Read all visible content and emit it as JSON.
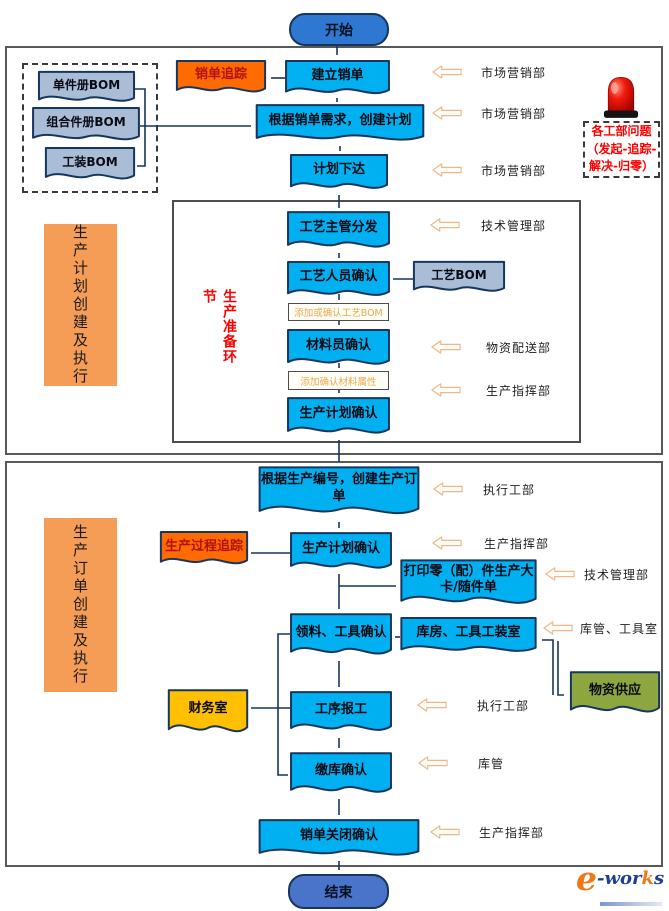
{
  "colors": {
    "process_fill": "#00b0f0",
    "doc_border": "#17365d",
    "bom_fill": "#a9bdd7",
    "tracking_fill": "#ff6b00",
    "tracking_text": "#b01210",
    "finance_fill": "#ffc000",
    "supply_fill": "#8ea640",
    "band_fill": "#f59d56",
    "start_fill": "#2e78d2",
    "end_fill": "#4a74c9",
    "line": "#17365d",
    "block_arrow_stroke": "#efb789",
    "block_arrow_fill": "#fffdf8",
    "red_text": "#ff0000",
    "note_text": "#e8a84f",
    "logo_orange": "#f07818",
    "logo_blue": "#1c3f94"
  },
  "nodes": {
    "start": "开始",
    "end": "结束",
    "create_sales_order": "建立销单",
    "sales_order_tracking": "销单追踪",
    "create_plan": "根据销单需求，创建计划",
    "plan_release": "计划下达",
    "bom_single": "单件册BOM",
    "bom_combo": "组合件册BOM",
    "bom_tooling": "工装BOM",
    "craft_dispatch": "工艺主管分发",
    "craft_confirm": "工艺人员确认",
    "craft_bom": "工艺BOM",
    "material_confirm": "材料员确认",
    "plan_confirm": "生产计划确认",
    "create_prod_order": "根据生产编号，创建生产订单",
    "prod_plan_confirm": "生产计划确认",
    "process_tracking": "生产过程追踪",
    "print_card": "打印零（配）件生产大卡/随件单",
    "pick_confirm": "领料、工具确认",
    "warehouse_room": "库房、工具工装室",
    "supply": "物资供应",
    "process_report": "工序报工",
    "finance": "财务室",
    "stockin_confirm": "缴库确认",
    "close_confirm": "销单关闭确认"
  },
  "notes": {
    "add_craft_bom": "添加或确认工艺BOM",
    "add_material_attr": "添加确认材料属性"
  },
  "bands": {
    "upper": "生产计划创建及执行",
    "lower": "生产订单创建及执行"
  },
  "prep_label": "生产准备环节",
  "alert_lines": [
    "各工部问题",
    "（发起-追踪-",
    "解决-归零）"
  ],
  "depts": [
    "市场营销部",
    "市场营销部",
    "市场营销部",
    "技术管理部",
    "物资配送部",
    "生产指挥部",
    "执行工部",
    "生产指挥部",
    "技术管理部",
    "库管、工具室",
    "执行工部",
    "库管",
    "生产指挥部"
  ],
  "logo": {
    "e": "e",
    "wor": "-wor",
    "k": "k",
    "s": "s"
  }
}
